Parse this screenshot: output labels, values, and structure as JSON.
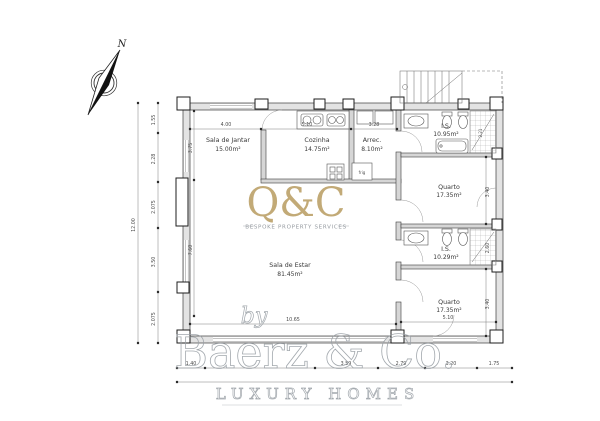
{
  "compass": {
    "north": "N"
  },
  "rooms": {
    "jantar": {
      "name": "Sala de Jantar",
      "area": "15.00m²"
    },
    "cozinha": {
      "name": "Cozinha",
      "area": "14.75m²"
    },
    "arrec": {
      "name": "Arrec.",
      "area": "8.10m²"
    },
    "is1": {
      "name": "I.S.",
      "area": "10.95m²"
    },
    "quarto1": {
      "name": "Quarto",
      "area": "17.35m²"
    },
    "is2": {
      "name": "I.S.",
      "area": "10.29m²"
    },
    "quarto2": {
      "name": "Quarto",
      "area": "17.35m²"
    },
    "estar": {
      "name": "Sala de Estar",
      "area": "81.45m²"
    }
  },
  "kitchen": {
    "fridge": "frig"
  },
  "dims": {
    "left_total": "12.00",
    "left": [
      "1.55",
      "2.28",
      "2.075",
      "3.50",
      "2.075"
    ],
    "left_inner": [
      "3.75",
      "7.60"
    ],
    "top": [
      "4.00",
      "5.10",
      "3.28"
    ],
    "right": [
      "2.21",
      "3.40",
      "2.60",
      "3.40"
    ],
    "estar_width": "10.65",
    "quarto2_width": "5.10",
    "bottom": [
      "1.40",
      "3.59",
      "2.79",
      "3.20",
      "1.75"
    ]
  },
  "watermarks": {
    "qc_logo": "Q&C",
    "qc_tagline": "BESPOKE PROPERTY SERVICES",
    "by": "by",
    "brand": "Baerz & Co.",
    "brand_tagline": "LUXURY HOMES"
  },
  "colors": {
    "gold": "#b5985a",
    "watermark_gray": "#9aa0a6",
    "wall_fill": "#e3e3e3",
    "line": "#3c3c3c"
  }
}
